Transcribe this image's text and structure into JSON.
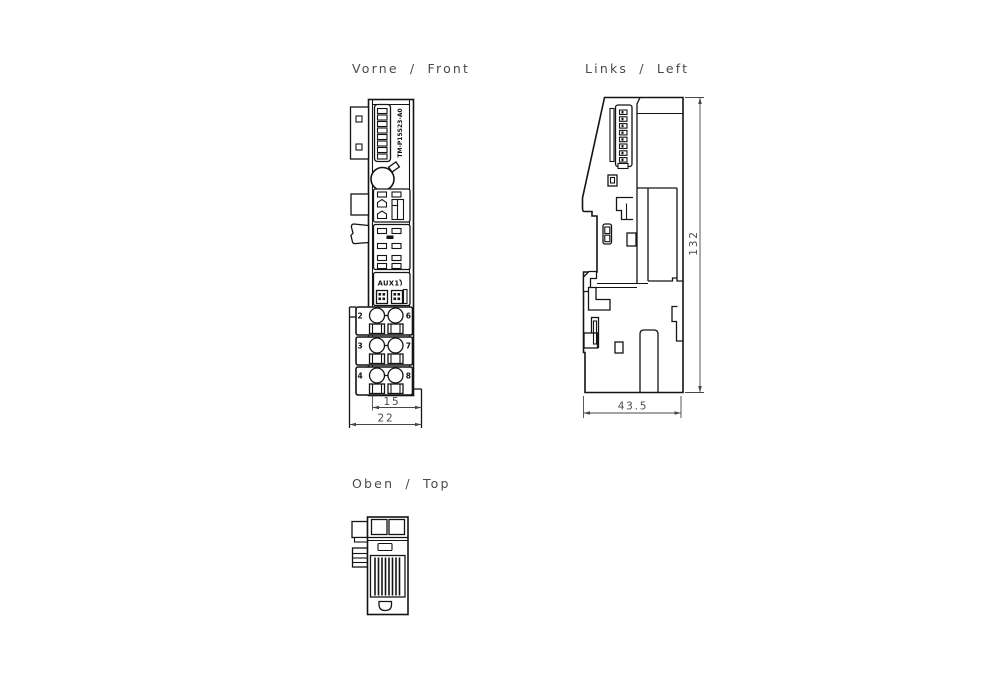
{
  "labels": {
    "front": "Vorne / Front",
    "left": "Links / Left",
    "top": "Oben / Top"
  },
  "front": {
    "module_code": "TM-P15S23-A0",
    "aux_label": "AUX1",
    "terminal_rows": [
      {
        "left": "2",
        "right": "6"
      },
      {
        "left": "3",
        "right": "7"
      },
      {
        "left": "4",
        "right": "8"
      }
    ],
    "dims": {
      "inner_width": "15",
      "outer_width": "22"
    }
  },
  "left": {
    "dims": {
      "height": "132",
      "depth": "43.5"
    }
  },
  "colors": {
    "line": "#141414",
    "dim_text": "#4a4a4a",
    "background": "#ffffff"
  }
}
